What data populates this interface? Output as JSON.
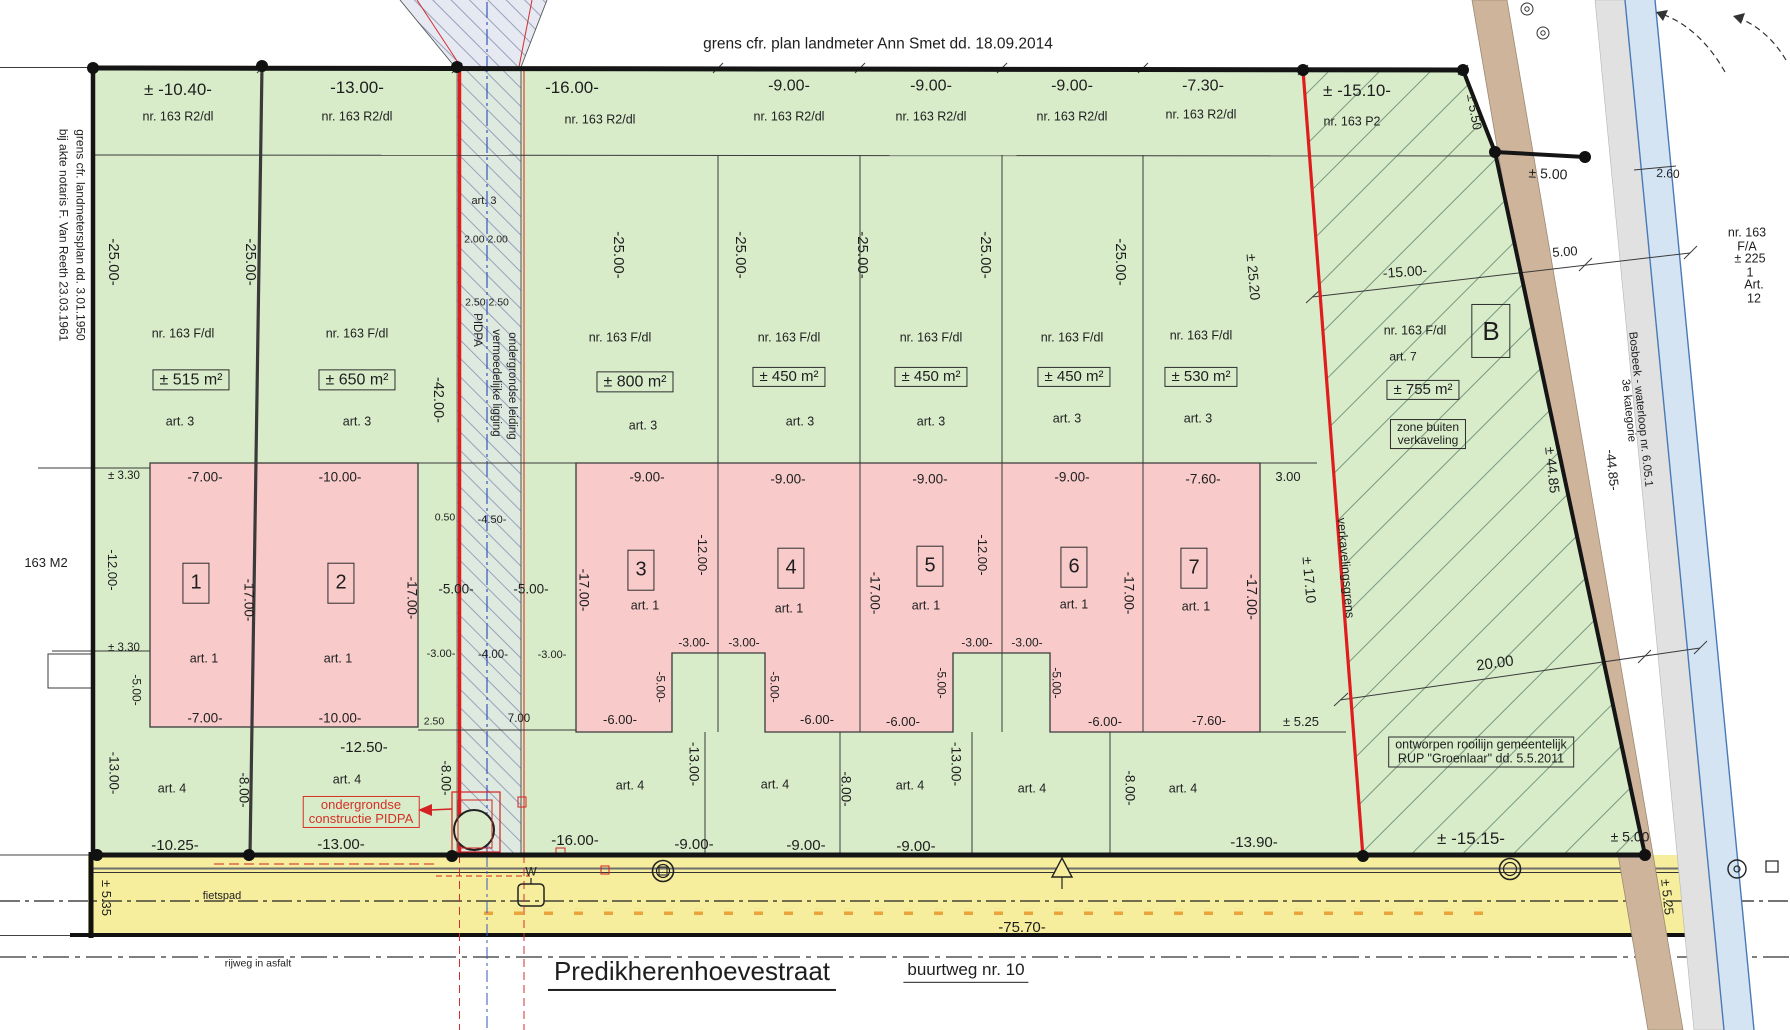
{
  "document": {
    "kind": "verkavelingsplan (land subdivision plan)",
    "street_name": "Predikherenhoevestraat",
    "street_byway": "buurtweg nr. 10",
    "top_boundary_note": "grens cfr. plan landmeter Ann Smet dd. 18.09.2014",
    "left_boundary_note": "grens cfr. landmetersplan dd. 3.01.1950 bij akte notaris F. Van Reeth 23.03.1961"
  },
  "colors": {
    "parcel_green": "#d8ecca",
    "building_pink": "#f8caca",
    "road_yellow": "#f6ee9c",
    "boundary_red": "#e01c1c",
    "path_brown": "#cdb49b",
    "water_blue": "#d4e4f3"
  },
  "labels": [
    {
      "t": "grens cfr. plan landmeter Ann Smet dd. 18.09.2014",
      "x": 878,
      "y": 45,
      "s": 15.5,
      "n": "boundary-note-top"
    },
    {
      "t": "± -10.40-",
      "x": 178,
      "y": 90,
      "s": 17,
      "n": "dim-front-lot1"
    },
    {
      "t": "-13.00-",
      "x": 357,
      "y": 88,
      "s": 17,
      "n": "dim-front-lot2"
    },
    {
      "t": "-16.00-",
      "x": 572,
      "y": 88,
      "s": 17,
      "n": "dim-front-lot3"
    },
    {
      "t": "-9.00-",
      "x": 789,
      "y": 86,
      "s": 16,
      "n": "dim-front-lot4"
    },
    {
      "t": "-9.00-",
      "x": 931,
      "y": 86,
      "s": 16,
      "n": "dim-front-lot5"
    },
    {
      "t": "-9.00-",
      "x": 1072,
      "y": 86,
      "s": 16,
      "n": "dim-front-lot6"
    },
    {
      "t": "-7.30-",
      "x": 1203,
      "y": 86,
      "s": 16,
      "n": "dim-front-lot7"
    },
    {
      "t": "± -15.10-",
      "x": 1357,
      "y": 91,
      "s": 17,
      "n": "dim-front-p2"
    },
    {
      "t": "± 5.50",
      "x": 1474,
      "y": 112,
      "r": 80,
      "s": 13,
      "n": "dim"
    },
    {
      "t": "± 5.00",
      "x": 1548,
      "y": 174,
      "r": 3,
      "s": 14,
      "n": "dim"
    },
    {
      "t": "2.60",
      "x": 1668,
      "y": 174,
      "r": 3,
      "s": 12,
      "n": "dim"
    },
    {
      "t": "5.00",
      "x": 1565,
      "y": 252,
      "r": -4,
      "s": 13,
      "n": "dim"
    },
    {
      "t": "-15.00-",
      "x": 1405,
      "y": 272,
      "r": -4,
      "s": 14,
      "n": "dim"
    },
    {
      "t": "nr. 163 R2/dl",
      "x": 178,
      "y": 117,
      "s": 12.5,
      "n": "parcel-label"
    },
    {
      "t": "nr. 163 R2/dl",
      "x": 357,
      "y": 117,
      "s": 12.5,
      "n": "parcel-label"
    },
    {
      "t": "nr. 163 R2/dl",
      "x": 600,
      "y": 120,
      "s": 12.5,
      "n": "parcel-label"
    },
    {
      "t": "nr. 163 R2/dl",
      "x": 789,
      "y": 117,
      "s": 12.5,
      "n": "parcel-label"
    },
    {
      "t": "nr. 163 R2/dl",
      "x": 931,
      "y": 117,
      "s": 12.5,
      "n": "parcel-label"
    },
    {
      "t": "nr. 163 R2/dl",
      "x": 1072,
      "y": 117,
      "s": 12.5,
      "n": "parcel-label"
    },
    {
      "t": "nr. 163 R2/dl",
      "x": 1201,
      "y": 115,
      "s": 12.5,
      "n": "parcel-label"
    },
    {
      "t": "nr. 163 P2",
      "x": 1352,
      "y": 122,
      "s": 12.5,
      "n": "parcel-label"
    },
    {
      "t": "-25.00-",
      "x": 113,
      "y": 262,
      "r": 90,
      "s": 15,
      "n": "dim-depth"
    },
    {
      "t": "-25.00-",
      "x": 250,
      "y": 262,
      "r": 90,
      "s": 15,
      "n": "dim-depth"
    },
    {
      "t": "-25.00-",
      "x": 618,
      "y": 255,
      "r": 90,
      "s": 15,
      "n": "dim-depth"
    },
    {
      "t": "-25.00-",
      "x": 740,
      "y": 255,
      "r": 90,
      "s": 15,
      "n": "dim-depth"
    },
    {
      "t": "-25.00-",
      "x": 862,
      "y": 255,
      "r": 90,
      "s": 15,
      "n": "dim-depth"
    },
    {
      "t": "-25.00-",
      "x": 985,
      "y": 255,
      "r": 90,
      "s": 15,
      "n": "dim-depth"
    },
    {
      "t": "-25.00-",
      "x": 1120,
      "y": 262,
      "r": 90,
      "s": 15,
      "n": "dim-depth"
    },
    {
      "t": "± 25.20",
      "x": 1253,
      "y": 277,
      "r": 85,
      "s": 14,
      "n": "dim-depth"
    },
    {
      "t": "grens cfr. landmetersplan dd. 3.01.1950",
      "x": 80,
      "y": 235,
      "r": 90,
      "s": 12,
      "n": "boundary-note-left"
    },
    {
      "t": "bij akte notaris F. Van Reeth 23.03.1961",
      "x": 63,
      "y": 235,
      "r": 90,
      "s": 12,
      "n": "boundary-note-left"
    },
    {
      "t": "163 M2",
      "x": 46,
      "y": 563,
      "s": 13,
      "n": "parcel-label-neighbour"
    },
    {
      "t": "± 3.30",
      "x": 124,
      "y": 476,
      "s": 11.5,
      "n": "dim"
    },
    {
      "t": "± 3.30",
      "x": 124,
      "y": 648,
      "s": 11.5,
      "n": "dim"
    },
    {
      "t": "-12.00-",
      "x": 112,
      "y": 570,
      "r": 90,
      "s": 13,
      "n": "dim"
    },
    {
      "t": "-5.00-",
      "x": 136,
      "y": 690,
      "r": 90,
      "s": 12,
      "n": "dim"
    },
    {
      "t": "-13.00-",
      "x": 113,
      "y": 773,
      "r": 90,
      "s": 13.5,
      "n": "dim"
    },
    {
      "t": "nr. 163 F/dl",
      "x": 183,
      "y": 334,
      "s": 12.5,
      "n": "parcel-label"
    },
    {
      "t": "nr. 163 F/dl",
      "x": 357,
      "y": 334,
      "s": 12.5,
      "n": "parcel-label"
    },
    {
      "t": "nr. 163 F/dl",
      "x": 620,
      "y": 338,
      "s": 12.5,
      "n": "parcel-label"
    },
    {
      "t": "nr. 163 F/dl",
      "x": 789,
      "y": 338,
      "s": 12.5,
      "n": "parcel-label"
    },
    {
      "t": "nr. 163 F/dl",
      "x": 931,
      "y": 338,
      "s": 12.5,
      "n": "parcel-label"
    },
    {
      "t": "nr. 163 F/dl",
      "x": 1072,
      "y": 338,
      "s": 12.5,
      "n": "parcel-label"
    },
    {
      "t": "nr. 163 F/dl",
      "x": 1201,
      "y": 336,
      "s": 12.5,
      "n": "parcel-label"
    },
    {
      "t": "± 515 m²",
      "x": 191,
      "y": 380,
      "s": 16,
      "c": "box",
      "n": "area-lot1"
    },
    {
      "t": "± 650 m²",
      "x": 357,
      "y": 380,
      "s": 16,
      "c": "box",
      "n": "area-lot2"
    },
    {
      "t": "± 800 m²",
      "x": 635,
      "y": 382,
      "s": 16,
      "c": "box",
      "n": "area-lot3"
    },
    {
      "t": "± 450 m²",
      "x": 789,
      "y": 377,
      "s": 15,
      "c": "box",
      "n": "area-lot4"
    },
    {
      "t": "± 450 m²",
      "x": 931,
      "y": 377,
      "s": 15,
      "c": "box",
      "n": "area-lot5"
    },
    {
      "t": "± 450 m²",
      "x": 1074,
      "y": 377,
      "s": 15,
      "c": "box",
      "n": "area-lot6"
    },
    {
      "t": "± 530 m²",
      "x": 1201,
      "y": 377,
      "s": 15,
      "c": "box",
      "n": "area-lot7"
    },
    {
      "t": "art. 3",
      "x": 180,
      "y": 422,
      "s": 12.5,
      "n": "zone-label"
    },
    {
      "t": "art. 3",
      "x": 357,
      "y": 422,
      "s": 12.5,
      "n": "zone-label"
    },
    {
      "t": "art. 3",
      "x": 643,
      "y": 426,
      "s": 12.5,
      "n": "zone-label"
    },
    {
      "t": "art. 3",
      "x": 800,
      "y": 422,
      "s": 12.5,
      "n": "zone-label"
    },
    {
      "t": "art. 3",
      "x": 931,
      "y": 422,
      "s": 12.5,
      "n": "zone-label"
    },
    {
      "t": "art. 3",
      "x": 1067,
      "y": 419,
      "s": 12.5,
      "n": "zone-label"
    },
    {
      "t": "art. 3",
      "x": 1198,
      "y": 419,
      "s": 12.5,
      "n": "zone-label"
    },
    {
      "t": "art. 3",
      "x": 484,
      "y": 202,
      "s": 11,
      "n": "zone-label"
    },
    {
      "t": "2.00 2.00",
      "x": 486,
      "y": 240,
      "s": 10.5,
      "n": "dim"
    },
    {
      "t": "2.50 2.50",
      "x": 487,
      "y": 303,
      "s": 10.5,
      "n": "dim"
    },
    {
      "t": "PIDPA",
      "x": 477,
      "y": 330,
      "r": 90,
      "s": 11.5,
      "n": "pipeline-label"
    },
    {
      "t": "vermoedelijke ligging",
      "x": 496,
      "y": 383,
      "r": 90,
      "s": 11.5,
      "n": "pipeline-label"
    },
    {
      "t": "ondergrondse leiding",
      "x": 512,
      "y": 386,
      "r": 90,
      "s": 11.5,
      "n": "pipeline-label"
    },
    {
      "t": "-42.00-",
      "x": 437,
      "y": 400,
      "r": 90,
      "s": 14.5,
      "n": "dim"
    },
    {
      "t": "0.50",
      "x": 445,
      "y": 518,
      "s": 10.5,
      "n": "dim"
    },
    {
      "t": "-4.50-",
      "x": 492,
      "y": 521,
      "s": 11,
      "n": "dim"
    },
    {
      "t": "-5.00-",
      "x": 456,
      "y": 590,
      "s": 13.5,
      "n": "dim"
    },
    {
      "t": "-5.00-",
      "x": 531,
      "y": 590,
      "s": 13.5,
      "n": "dim"
    },
    {
      "t": "-3.00-",
      "x": 441,
      "y": 655,
      "s": 11,
      "n": "dim"
    },
    {
      "t": "-4.00-",
      "x": 493,
      "y": 655,
      "s": 11.5,
      "n": "dim"
    },
    {
      "t": "-3.00-",
      "x": 552,
      "y": 656,
      "s": 11,
      "n": "dim"
    },
    {
      "t": "2.50",
      "x": 434,
      "y": 722,
      "s": 10.5,
      "n": "dim"
    },
    {
      "t": "7.00",
      "x": 519,
      "y": 719,
      "s": 11.5,
      "n": "dim"
    },
    {
      "t": "-8.00-",
      "x": 445,
      "y": 778,
      "r": 90,
      "s": 13.5,
      "n": "dim"
    },
    {
      "t": "-7.00-",
      "x": 205,
      "y": 478,
      "s": 13.5,
      "n": "dim-build-lot1"
    },
    {
      "t": "-10.00-",
      "x": 340,
      "y": 478,
      "s": 13.5,
      "n": "dim-build-lot2"
    },
    {
      "t": "-9.00-",
      "x": 647,
      "y": 478,
      "s": 13.5,
      "n": "dim-build-lot3"
    },
    {
      "t": "-9.00-",
      "x": 788,
      "y": 480,
      "s": 13.5,
      "n": "dim-build-lot4"
    },
    {
      "t": "-9.00-",
      "x": 930,
      "y": 480,
      "s": 13.5,
      "n": "dim-build-lot5"
    },
    {
      "t": "-9.00-",
      "x": 1072,
      "y": 478,
      "s": 13.5,
      "n": "dim-build-lot6"
    },
    {
      "t": "-7.60-",
      "x": 1203,
      "y": 480,
      "s": 13.5,
      "n": "dim-build-lot7"
    },
    {
      "t": "3.00",
      "x": 1288,
      "y": 477,
      "s": 13,
      "n": "dim"
    },
    {
      "t": "1",
      "x": 196,
      "y": 583,
      "s": 20,
      "c": "box num",
      "n": "lot-number-1"
    },
    {
      "t": "2",
      "x": 341,
      "y": 583,
      "s": 20,
      "c": "box num",
      "n": "lot-number-2"
    },
    {
      "t": "3",
      "x": 641,
      "y": 570,
      "s": 20,
      "c": "box num",
      "n": "lot-number-3"
    },
    {
      "t": "4",
      "x": 791,
      "y": 568,
      "s": 20,
      "c": "box num",
      "n": "lot-number-4"
    },
    {
      "t": "5",
      "x": 930,
      "y": 566,
      "s": 20,
      "c": "box num",
      "n": "lot-number-5"
    },
    {
      "t": "6",
      "x": 1074,
      "y": 567,
      "s": 20,
      "c": "box num",
      "n": "lot-number-6"
    },
    {
      "t": "7",
      "x": 1194,
      "y": 568,
      "s": 20,
      "c": "box num",
      "n": "lot-number-7"
    },
    {
      "t": "art. 1",
      "x": 204,
      "y": 659,
      "s": 12.5,
      "n": "zone-label"
    },
    {
      "t": "art. 1",
      "x": 338,
      "y": 659,
      "s": 12.5,
      "n": "zone-label"
    },
    {
      "t": "art. 1",
      "x": 645,
      "y": 606,
      "s": 12.5,
      "n": "zone-label"
    },
    {
      "t": "art. 1",
      "x": 789,
      "y": 609,
      "s": 12.5,
      "n": "zone-label"
    },
    {
      "t": "art. 1",
      "x": 926,
      "y": 606,
      "s": 12.5,
      "n": "zone-label"
    },
    {
      "t": "art. 1",
      "x": 1074,
      "y": 605,
      "s": 12.5,
      "n": "zone-label"
    },
    {
      "t": "art. 1",
      "x": 1196,
      "y": 607,
      "s": 12.5,
      "n": "zone-label"
    },
    {
      "t": "-7.00-",
      "x": 205,
      "y": 719,
      "s": 13.5,
      "n": "dim"
    },
    {
      "t": "-10.00-",
      "x": 340,
      "y": 719,
      "s": 13.5,
      "n": "dim"
    },
    {
      "t": "-17.00-",
      "x": 248,
      "y": 600,
      "r": 90,
      "s": 13.5,
      "n": "dim"
    },
    {
      "t": "-17.00-",
      "x": 411,
      "y": 598,
      "r": 90,
      "s": 13.5,
      "n": "dim"
    },
    {
      "t": "-17.00-",
      "x": 583,
      "y": 590,
      "r": 90,
      "s": 13.5,
      "n": "dim"
    },
    {
      "t": "-17.00-",
      "x": 874,
      "y": 593,
      "r": 90,
      "s": 13.5,
      "n": "dim"
    },
    {
      "t": "-17.00-",
      "x": 1128,
      "y": 593,
      "r": 90,
      "s": 13.5,
      "n": "dim"
    },
    {
      "t": "-17.00-",
      "x": 1250,
      "y": 597,
      "r": 90,
      "s": 14.5,
      "n": "dim"
    },
    {
      "t": "-12.00-",
      "x": 702,
      "y": 555,
      "r": 90,
      "s": 13,
      "n": "dim"
    },
    {
      "t": "-12.00-",
      "x": 982,
      "y": 555,
      "r": 90,
      "s": 13,
      "n": "dim"
    },
    {
      "t": "-3.00-",
      "x": 694,
      "y": 643,
      "s": 12,
      "n": "dim"
    },
    {
      "t": "-3.00-",
      "x": 744,
      "y": 643,
      "s": 12,
      "n": "dim"
    },
    {
      "t": "-3.00-",
      "x": 977,
      "y": 643,
      "s": 12,
      "n": "dim"
    },
    {
      "t": "-3.00-",
      "x": 1027,
      "y": 643,
      "s": 12,
      "n": "dim"
    },
    {
      "t": "-5.00-",
      "x": 660,
      "y": 687,
      "r": 90,
      "s": 12,
      "n": "dim"
    },
    {
      "t": "-5.00-",
      "x": 774,
      "y": 687,
      "r": 90,
      "s": 12,
      "n": "dim"
    },
    {
      "t": "-5.00-",
      "x": 941,
      "y": 683,
      "r": 90,
      "s": 12,
      "n": "dim"
    },
    {
      "t": "-5.00-",
      "x": 1056,
      "y": 683,
      "r": 90,
      "s": 12,
      "n": "dim"
    },
    {
      "t": "-6.00-",
      "x": 620,
      "y": 720,
      "s": 13,
      "n": "dim"
    },
    {
      "t": "-6.00-",
      "x": 817,
      "y": 720,
      "s": 13,
      "n": "dim"
    },
    {
      "t": "-6.00-",
      "x": 903,
      "y": 722,
      "s": 13,
      "n": "dim"
    },
    {
      "t": "-6.00-",
      "x": 1105,
      "y": 722,
      "s": 13,
      "n": "dim"
    },
    {
      "t": "-7.60-",
      "x": 1209,
      "y": 721,
      "s": 13,
      "n": "dim"
    },
    {
      "t": "± 5.25",
      "x": 1301,
      "y": 722,
      "s": 13,
      "n": "dim"
    },
    {
      "t": "art. 4",
      "x": 172,
      "y": 789,
      "s": 12.5,
      "n": "zone-label"
    },
    {
      "t": "art. 4",
      "x": 347,
      "y": 780,
      "s": 12.5,
      "n": "zone-label"
    },
    {
      "t": "art. 4",
      "x": 630,
      "y": 786,
      "s": 12.5,
      "n": "zone-label"
    },
    {
      "t": "art. 4",
      "x": 775,
      "y": 785,
      "s": 12.5,
      "n": "zone-label"
    },
    {
      "t": "art. 4",
      "x": 910,
      "y": 786,
      "s": 12.5,
      "n": "zone-label"
    },
    {
      "t": "art. 4",
      "x": 1032,
      "y": 789,
      "s": 12.5,
      "n": "zone-label"
    },
    {
      "t": "art. 4",
      "x": 1183,
      "y": 789,
      "s": 12.5,
      "n": "zone-label"
    },
    {
      "t": "-12.50-",
      "x": 364,
      "y": 748,
      "s": 15,
      "n": "dim"
    },
    {
      "t": "ondergrondse\nconstructie PIDPA",
      "x": 361,
      "y": 812,
      "s": 13,
      "c": "rbox",
      "n": "pidpa-construction-note"
    },
    {
      "t": "-8.00-",
      "x": 243,
      "y": 790,
      "r": 90,
      "s": 13.5,
      "n": "dim"
    },
    {
      "t": "-8.00-",
      "x": 845,
      "y": 789,
      "r": 90,
      "s": 13.5,
      "n": "dim"
    },
    {
      "t": "-8.00-",
      "x": 1129,
      "y": 788,
      "r": 90,
      "s": 13.5,
      "n": "dim"
    },
    {
      "t": "-13.00-",
      "x": 694,
      "y": 764,
      "r": 90,
      "s": 14,
      "n": "dim"
    },
    {
      "t": "-13.00-",
      "x": 956,
      "y": 764,
      "r": 90,
      "s": 14,
      "n": "dim"
    },
    {
      "t": "-10.25-",
      "x": 175,
      "y": 846,
      "s": 15,
      "n": "dim"
    },
    {
      "t": "-13.00-",
      "x": 341,
      "y": 845,
      "s": 15,
      "n": "dim"
    },
    {
      "t": "-16.00-",
      "x": 575,
      "y": 841,
      "s": 15,
      "n": "dim"
    },
    {
      "t": "-9.00-",
      "x": 694,
      "y": 845,
      "s": 15,
      "n": "dim"
    },
    {
      "t": "-9.00-",
      "x": 806,
      "y": 846,
      "s": 15,
      "n": "dim"
    },
    {
      "t": "-9.00-",
      "x": 916,
      "y": 847,
      "s": 15,
      "n": "dim"
    },
    {
      "t": "-13.90-",
      "x": 1254,
      "y": 843,
      "s": 15,
      "n": "dim"
    },
    {
      "t": "± -15.15-",
      "x": 1471,
      "y": 839,
      "s": 17,
      "n": "dim"
    },
    {
      "t": "± 5.00",
      "x": 1630,
      "y": 837,
      "s": 14,
      "n": "dim"
    },
    {
      "t": "verkavelingsgrens",
      "x": 1345,
      "y": 568,
      "r": 85,
      "s": 12.5,
      "n": "subdivision-boundary-label"
    },
    {
      "t": "± 17.10",
      "x": 1309,
      "y": 580,
      "r": 85,
      "s": 14,
      "n": "dim"
    },
    {
      "t": "nr. 163 F/dl",
      "x": 1415,
      "y": 331,
      "s": 12.5,
      "n": "parcel-label"
    },
    {
      "t": "art. 7",
      "x": 1403,
      "y": 357,
      "s": 12,
      "n": "zone-label"
    },
    {
      "t": "± 755 m²",
      "x": 1423,
      "y": 390,
      "s": 15,
      "c": "box",
      "n": "area-lot-b"
    },
    {
      "t": "zone buiten\nverkaveling",
      "x": 1428,
      "y": 434,
      "s": 12,
      "c": "box",
      "n": "zone-outside-note"
    },
    {
      "t": "B",
      "x": 1491,
      "y": 331,
      "s": 26,
      "c": "box bnum",
      "n": "lot-number-b"
    },
    {
      "t": "20.00",
      "x": 1495,
      "y": 664,
      "r": -8,
      "s": 15,
      "n": "dim"
    },
    {
      "t": "ontworpen rooilijn gemeentelijk\nRUP \"Groenlaar\" dd. 5.5.2011",
      "x": 1481,
      "y": 752,
      "s": 12.5,
      "c": "box",
      "n": "rooilijn-note"
    },
    {
      "t": "± 44.85",
      "x": 1552,
      "y": 470,
      "r": 84,
      "s": 14,
      "n": "dim"
    },
    {
      "t": "-44.85-",
      "x": 1612,
      "y": 470,
      "r": 84,
      "s": 13,
      "n": "dim"
    },
    {
      "t": "Bosbeek  -  waterloop nr. 6.05.1  3e kategorie",
      "x": 1634,
      "y": 410,
      "r": 84,
      "s": 11.5,
      "n": "waterway-label"
    },
    {
      "t": "nr. 163 F/A",
      "x": 1747,
      "y": 240,
      "s": 12.5,
      "n": "parcel-label"
    },
    {
      "t": "± 225 1",
      "x": 1750,
      "y": 266,
      "s": 12.5,
      "n": "area-label"
    },
    {
      "t": "Art. 12",
      "x": 1754,
      "y": 292,
      "s": 12.5,
      "n": "zone-label"
    },
    {
      "t": "fietspad",
      "x": 222,
      "y": 897,
      "s": 11,
      "n": "bike-path-label"
    },
    {
      "t": "± 5.35",
      "x": 106,
      "y": 898,
      "r": 90,
      "s": 13,
      "n": "dim"
    },
    {
      "t": "± 5.25",
      "x": 1667,
      "y": 897,
      "r": 84,
      "s": 13,
      "n": "dim"
    },
    {
      "t": "-75.70-",
      "x": 1022,
      "y": 928,
      "s": 15,
      "n": "dim-road-length"
    },
    {
      "t": "rijweg in asfalt",
      "x": 258,
      "y": 964,
      "s": 10.5,
      "n": "road-surface-label"
    },
    {
      "t": "Predikherenhoevestraat",
      "x": 692,
      "y": 974,
      "s": 26,
      "c": "u2",
      "n": "street-name"
    },
    {
      "t": "buurtweg nr. 10",
      "x": 966,
      "y": 972,
      "s": 17,
      "c": "u1",
      "n": "street-byway"
    },
    {
      "t": "W",
      "x": 531,
      "y": 872,
      "s": 12,
      "n": "water-valve-label"
    }
  ]
}
